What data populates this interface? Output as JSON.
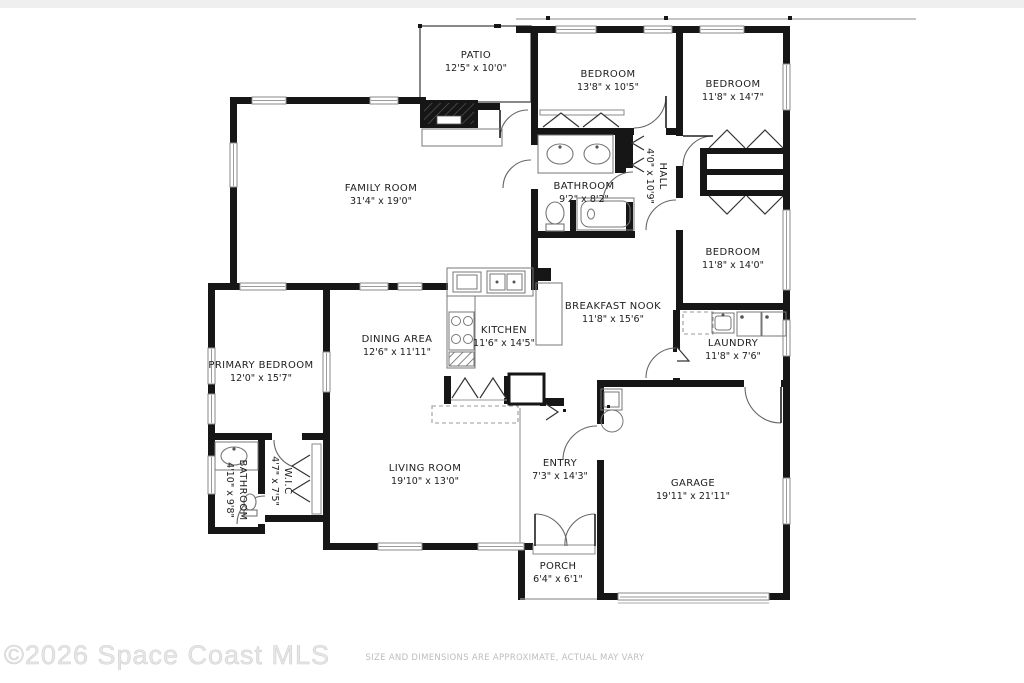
{
  "plan": {
    "watermark": "©2026 Space Coast MLS",
    "disclaimer": "SIZE AND DIMENSIONS ARE APPROXIMATE, ACTUAL MAY VARY"
  },
  "colors": {
    "wall": "#161616",
    "label": "#1d1d1d",
    "watermark": "#e6e6e6",
    "disclaimer": "#bdbdbd"
  },
  "rooms": [
    {
      "id": "patio",
      "name": "PATIO",
      "dims": "12'5\" x 10'0\""
    },
    {
      "id": "bedroom-top",
      "name": "BEDROOM",
      "dims": "13'8\" x 10'5\""
    },
    {
      "id": "bedroom-top-right",
      "name": "BEDROOM",
      "dims": "11'8\" x 14'7\""
    },
    {
      "id": "family-room",
      "name": "FAMILY ROOM",
      "dims": "31'4\" x 19'0\""
    },
    {
      "id": "bathroom-hall",
      "name": "BATHROOM",
      "dims": "9'2\" x 8'2\""
    },
    {
      "id": "hall",
      "name": "HALL",
      "dims": "4'0\" x 10'9\""
    },
    {
      "id": "bedroom-right",
      "name": "BEDROOM",
      "dims": "11'8\" x 14'0\""
    },
    {
      "id": "breakfast-nook",
      "name": "BREAKFAST NOOK",
      "dims": "11'8\" x 15'6\""
    },
    {
      "id": "kitchen",
      "name": "KITCHEN",
      "dims": "11'6\" x 14'5\""
    },
    {
      "id": "laundry",
      "name": "LAUNDRY",
      "dims": "11'8\" x 7'6\""
    },
    {
      "id": "primary-bedroom",
      "name": "PRIMARY BEDROOM",
      "dims": "12'0\" x 15'7\""
    },
    {
      "id": "dining-area",
      "name": "DINING AREA",
      "dims": "12'6\" x 11'11\""
    },
    {
      "id": "bathroom-primary",
      "name": "BATHROOM",
      "dims": "4'10\" x 9'8\""
    },
    {
      "id": "wic",
      "name": "W.I.C",
      "dims": "4'7\" x 7'5\""
    },
    {
      "id": "living-room",
      "name": "LIVING ROOM",
      "dims": "19'10\" x 13'0\""
    },
    {
      "id": "entry",
      "name": "ENTRY",
      "dims": "7'3\" x 14'3\""
    },
    {
      "id": "garage",
      "name": "GARAGE",
      "dims": "19'11\" x 21'11\""
    },
    {
      "id": "porch",
      "name": "PORCH",
      "dims": "6'4\" x 6'1\""
    }
  ],
  "fixtures": [
    "fireplace",
    "hearth",
    "double-sink-vanity",
    "toilet",
    "bathtub",
    "kitchen-sink",
    "dishwasher",
    "range",
    "refrigerator",
    "breakfast-bar",
    "laundry-sink",
    "washer",
    "dryer",
    "water-heater",
    "water-softener",
    "vanity-sink",
    "closet-bifold-doors",
    "garage-door",
    "front-double-door"
  ]
}
